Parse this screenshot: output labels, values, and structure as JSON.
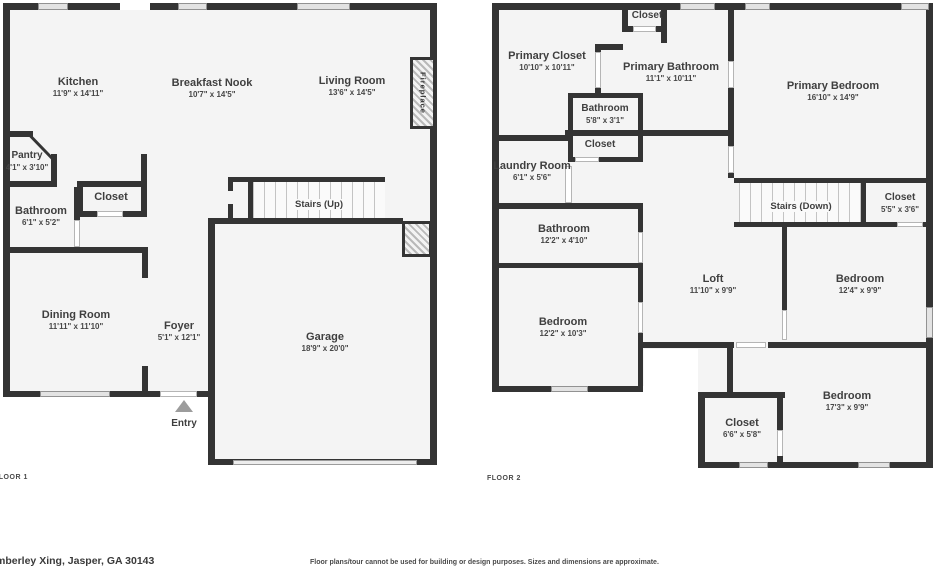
{
  "colors": {
    "wall": "#343434",
    "floor": "#f4f4f4",
    "text": "#3f3f3f",
    "window": "#e3e3e3"
  },
  "floors": [
    {
      "label": "FLOOR 1",
      "rooms": [
        {
          "name": "Kitchen",
          "dims": "11'9\" x 14'11\""
        },
        {
          "name": "Breakfast Nook",
          "dims": "10'7\" x 14'5\""
        },
        {
          "name": "Living Room",
          "dims": "13'6\" x 14'5\""
        },
        {
          "name": "Pantry",
          "dims": "4'1\" x 3'10\""
        },
        {
          "name": "Closet"
        },
        {
          "name": "Bathroom",
          "dims": "6'1\" x 5'2\""
        },
        {
          "name": "Dining Room",
          "dims": "11'11\" x 11'10\""
        },
        {
          "name": "Foyer",
          "dims": "5'1\" x 12'1\""
        },
        {
          "name": "Garage",
          "dims": "18'9\" x 20'0\""
        },
        {
          "name": "Stairs (Up)"
        },
        {
          "name": "Fireplace"
        },
        {
          "name": "Entry"
        }
      ]
    },
    {
      "label": "FLOOR 2",
      "rooms": [
        {
          "name": "Primary Closet",
          "dims": "10'10\" x 10'11\""
        },
        {
          "name": "Closet"
        },
        {
          "name": "Primary Bathroom",
          "dims": "11'1\" x 10'11\""
        },
        {
          "name": "Bathroom",
          "dims": "5'8\" x 3'1\""
        },
        {
          "name": "Closet"
        },
        {
          "name": "Laundry Room",
          "dims": "6'1\" x 5'6\""
        },
        {
          "name": "Primary Bedroom",
          "dims": "16'10\" x 14'9\""
        },
        {
          "name": "Stairs (Down)"
        },
        {
          "name": "Closet",
          "dims": "5'5\" x 3'6\""
        },
        {
          "name": "Bathroom",
          "dims": "12'2\" x 4'10\""
        },
        {
          "name": "Loft",
          "dims": "11'10\" x 9'9\""
        },
        {
          "name": "Bedroom",
          "dims": "12'4\" x 9'9\""
        },
        {
          "name": "Bedroom",
          "dims": "12'2\" x 10'3\""
        },
        {
          "name": "Bedroom",
          "dims": "17'3\" x 9'9\""
        },
        {
          "name": "Closet",
          "dims": "6'6\" x 5'8\""
        }
      ]
    }
  ],
  "footer": {
    "address": "mberley Xing, Jasper, GA 30143",
    "disclaimer": "Floor plans/tour cannot be used for building or design purposes. Sizes and dimensions are approximate."
  }
}
